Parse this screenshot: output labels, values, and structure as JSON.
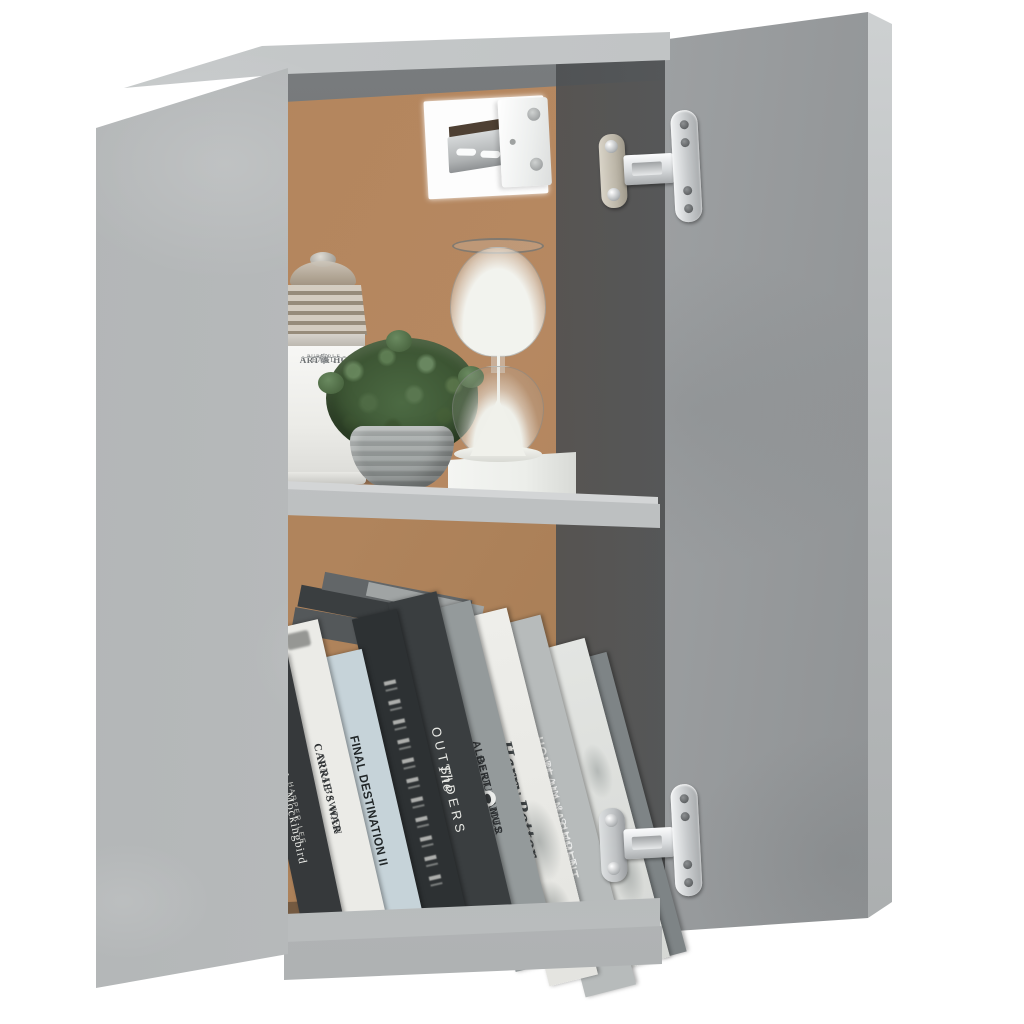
{
  "scene": {
    "subject": "Wall-mounted cabinet with open door, concrete gray finish",
    "background": "#ffffff",
    "compartments": 2
  },
  "palette": {
    "concrete": "#b6b9ba",
    "concrete_light": "#c9cccd",
    "concrete_dark": "#8e9193",
    "interior_back_panel": "#b0845c",
    "interior_shadow": "#55585a",
    "shelf_edge": "#c2c5c6",
    "metal_silver": "#dfe2e3",
    "plant_green": "#4c6a43",
    "pot_gray": "#9aa09f",
    "sand_white": "#f0f1ec"
  },
  "top_shelf": {
    "jar": {
      "crest": "♛",
      "label_line1": "ART & HO",
      "label_line2": "PURE BLE",
      "label_line3": "EARL",
      "flourish": "✻"
    },
    "plant": "potted green shrub in stone pot",
    "hourglass": "glass hourglass with white sand on white base"
  },
  "books": [
    {
      "title": "To Kill a Mockingbird",
      "author": "HARPER LEE",
      "spine": "#36393b",
      "ink": "#e9eae6"
    },
    {
      "title": "CARRIE'S WAR",
      "author": "NINA BAWDEN",
      "spine": "#ebebe7",
      "ink": "#2c2f31"
    },
    {
      "title": "FINAL DESTINATION II",
      "author": "",
      "spine": "#c6d3d9",
      "ink": "#212628"
    },
    {
      "title": "",
      "note": "ornate illegible lettering",
      "spine": "#2d3133",
      "ink": "#d8d9d5"
    },
    {
      "title_script": "The",
      "title": "OUTSIDERS",
      "spine": "#3a3e40",
      "ink": "#e8e9e5"
    },
    {
      "author": "ALBERT CAMUS",
      "title": "the OUTSIDER",
      "spine": "#949a9b",
      "ink": "#2e3133"
    },
    {
      "title": "Harry Potter",
      "spine": "#e8e8e5",
      "ink": "#43484a"
    },
    {
      "title": "HOME MANAGEMENT",
      "subtitle": "PLAIN & SIMPLE",
      "spine": "#b7bbbb",
      "ink": "#f3f4f2"
    },
    {
      "title": "",
      "note": "pale spine with faint print",
      "spine": "#dfe1de"
    },
    {
      "title": "",
      "note": "plain gray spine",
      "spine": "#7e8486"
    }
  ],
  "hardware": {
    "hinge_count": 2,
    "hinge_type": "chrome concealed hinges on open door",
    "bracket": "wall-hanging bracket in top back panel cutout"
  }
}
